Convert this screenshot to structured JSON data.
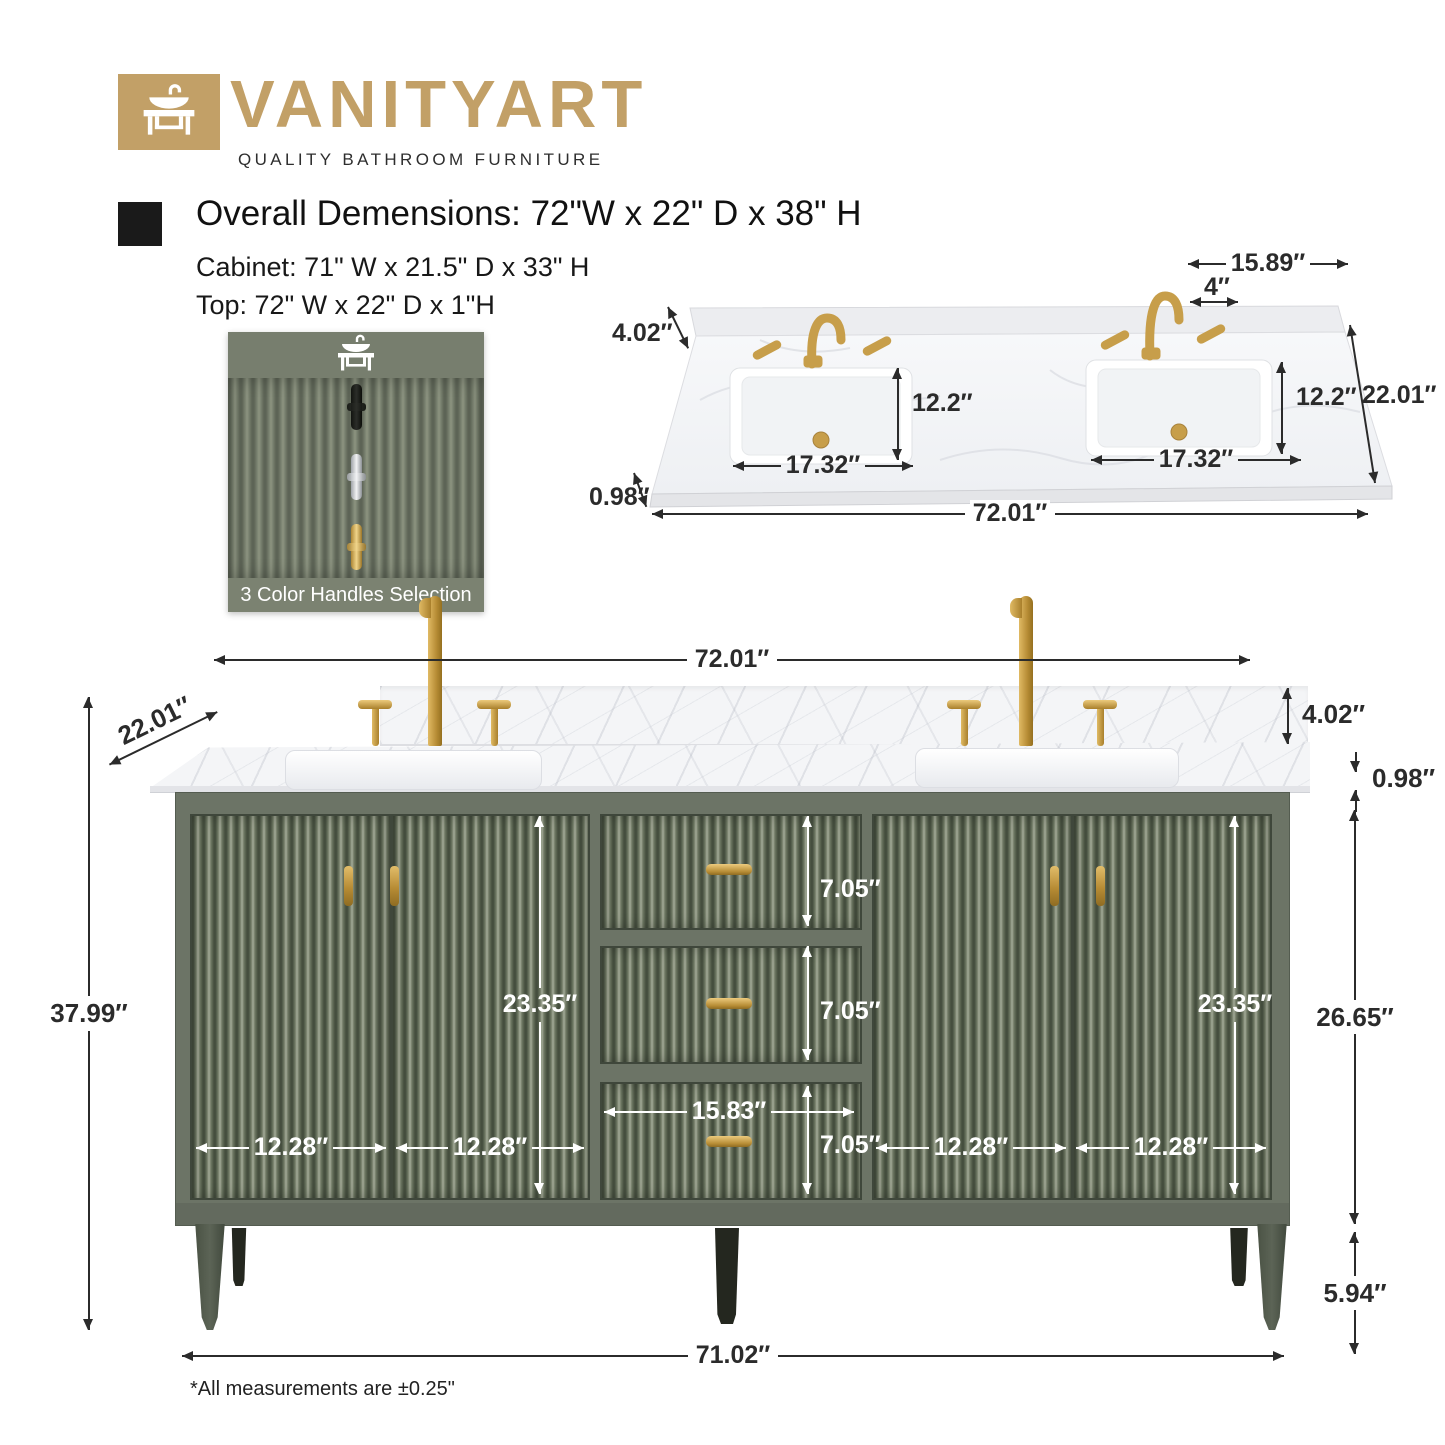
{
  "brand": {
    "name": "VANITYART",
    "tagline": "QUALITY BATHROOM FURNITURE",
    "logo_icon": "vanity-sink-icon"
  },
  "specs": {
    "overall": "Overall Demensions: 72\"W x 22\" D x 38\" H",
    "cabinet": "Cabinet: 71\" W x 21.5\" D x 33\" H",
    "top": "Top: 72\" W x 22\" D x 1\"H"
  },
  "handles_panel": {
    "caption": "3 Color Handles Selection",
    "options": [
      "black",
      "chrome",
      "gold"
    ]
  },
  "top_view": {
    "back_center_width": "15.89″",
    "faucet_hole_spacing": "4″",
    "backsplash_height": "4.02″",
    "left_sink_depth": "12.2″",
    "right_sink_depth": "12.2″",
    "counter_depth": "22.01″",
    "left_sink_width": "17.32″",
    "right_sink_width": "17.32″",
    "counter_thickness": "0.98″",
    "counter_width": "72.01″"
  },
  "front_view": {
    "counter_width": "72.01″",
    "counter_depth": "22.01″",
    "overall_height": "37.99″",
    "backsplash_height": "4.02″",
    "counter_thickness": "0.98″",
    "drawer_heights": [
      "7.05″",
      "7.05″",
      "7.05″"
    ],
    "drawer_width": "15.83″",
    "door_widths": [
      "12.28″",
      "12.28″",
      "12.28″",
      "12.28″"
    ],
    "left_door_height": "23.35″",
    "right_door_height": "23.35″",
    "cabinet_body_height": "26.65″",
    "leg_height": "5.94″",
    "base_width": "71.02″"
  },
  "footnote": "*All measurements are ±0.25\"",
  "colors": {
    "brand_gold": "#c2a067",
    "cabinet_green": "#6c7466",
    "hardware_gold": "#c79e4a",
    "marble_white": "#f4f5f7"
  }
}
